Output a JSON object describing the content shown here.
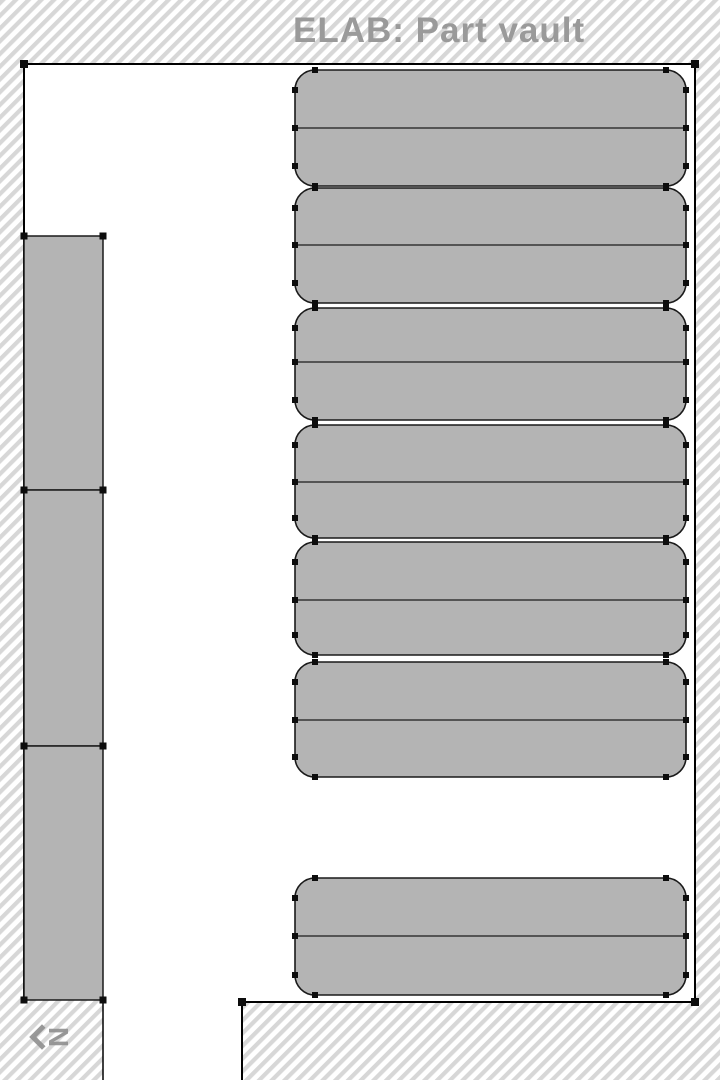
{
  "title": "ELAB: Part vault",
  "compass": {
    "label": "N"
  },
  "colors": {
    "hatch_stripe": "#d7d7d7",
    "hatch_bg": "#ffffff",
    "floor": "#ffffff",
    "wall_stroke": "#000000",
    "shape_fill": "#b4b4b4",
    "shape_stroke": "#1a1a1a",
    "divider_stroke": "#1a1a1a",
    "handle": "#0d0d0d",
    "title_text": "#9a9a9a",
    "compass_text": "#8f8f8f"
  },
  "floorplan": {
    "canvas": {
      "width": 720,
      "height": 1080
    },
    "room_path": "M24,64 L695,64 L695,1002 L242,1002 L242,1080 L103,1080 L103,1000 L24,1000 Z",
    "wall_path": "M24,1000 L24,64 L695,64 L695,1002 L242,1002 L242,1080",
    "corridor_line": "M103,1000 L103,1080",
    "racks": {
      "x": 295,
      "width": 391,
      "corner_radius": 20,
      "units": [
        {
          "y_top": 70,
          "y_bottom": 186,
          "divider_y": 128
        },
        {
          "y_top": 188,
          "y_bottom": 303,
          "divider_y": 245
        },
        {
          "y_top": 308,
          "y_bottom": 420,
          "divider_y": 362
        },
        {
          "y_top": 425,
          "y_bottom": 538,
          "divider_y": 482
        },
        {
          "y_top": 542,
          "y_bottom": 655,
          "divider_y": 600
        },
        {
          "y_top": 662,
          "y_bottom": 777,
          "divider_y": 720
        },
        {
          "y_top": 878,
          "y_bottom": 995,
          "divider_y": 936
        }
      ]
    },
    "left_shelves": {
      "x": 24,
      "width": 79,
      "units": [
        {
          "y_top": 236,
          "y_bottom": 490
        },
        {
          "y_top": 490,
          "y_bottom": 746
        },
        {
          "y_top": 746,
          "y_bottom": 1000
        }
      ]
    },
    "wall_handles": [
      [
        24,
        64
      ],
      [
        695,
        64
      ],
      [
        695,
        1002
      ],
      [
        242,
        1002
      ]
    ]
  }
}
